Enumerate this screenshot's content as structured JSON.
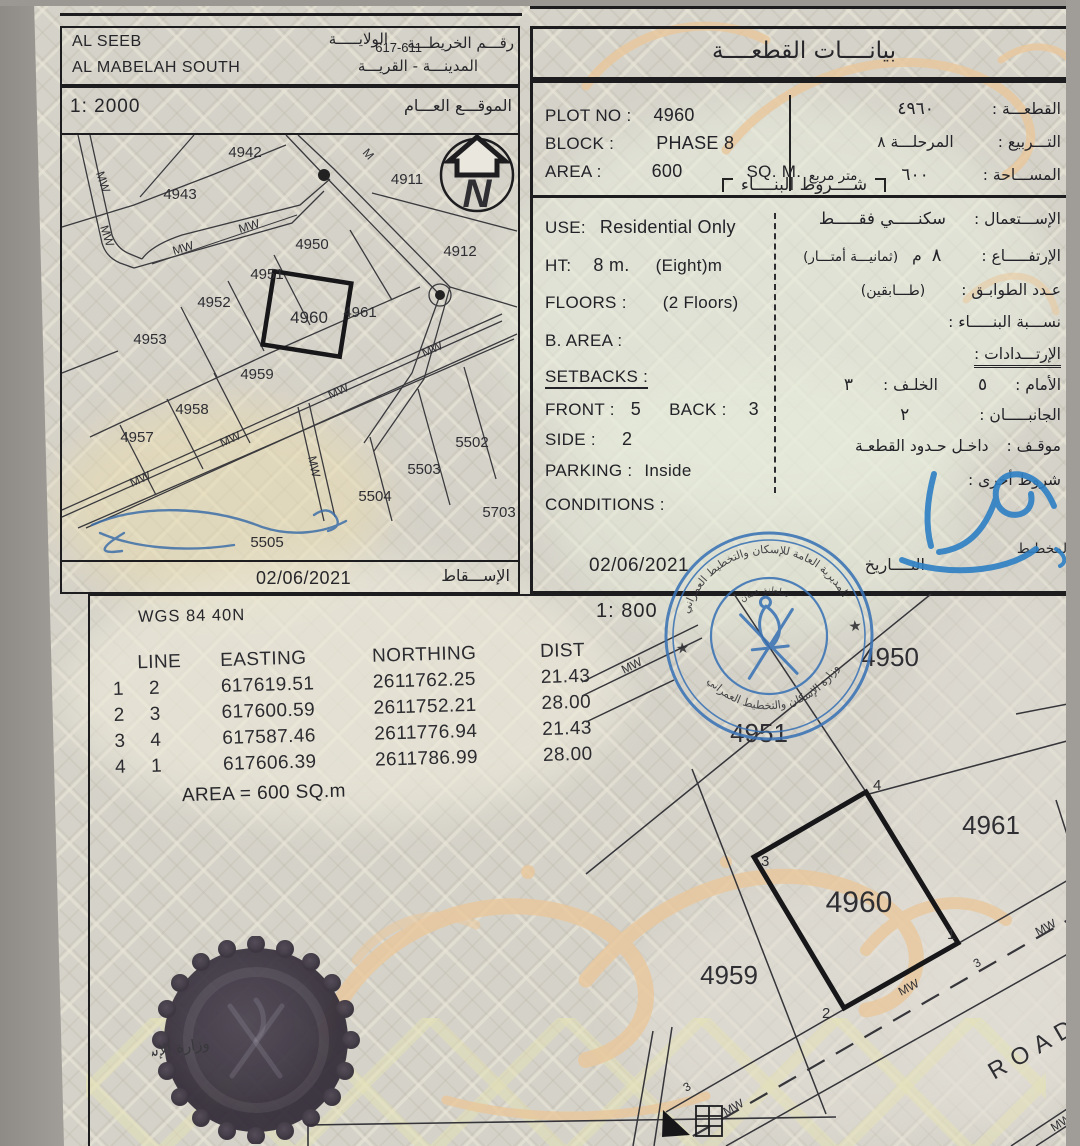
{
  "header_left": {
    "wilaya_en": "AL SEEB",
    "wilaya_label_ar": "الولايـــــة",
    "map_no": "617-611",
    "map_no_label_ar": "رقـــم الخريطـــة",
    "city_en": "AL MABELAH SOUTH",
    "city_label_ar": "المدينـــة - القريـــة"
  },
  "sitemap": {
    "scale": "1: 2000",
    "title_ar": "الموقـــع العـــام",
    "footer_date": "02/06/2021",
    "footer_label_ar": "الإســـقاط",
    "north_letter": "N",
    "road_label": "MW",
    "plots": [
      "4942",
      "4943",
      "4911",
      "4950",
      "4951",
      "4912",
      "4952",
      "4961",
      "4960",
      "4953",
      "4959",
      "4958",
      "4957",
      "5502",
      "5503",
      "5504",
      "5703",
      "5505"
    ]
  },
  "plot_data": {
    "title_ar": "بيانــــات القطعــــة",
    "plot_no_label": "PLOT NO :",
    "plot_no": "4960",
    "plot_no_label_ar": "القطعـــة :",
    "plot_no_ar": "٤٩٦٠",
    "block_label": "BLOCK :",
    "block": "PHASE 8",
    "block_label_ar": "التـــربيع :",
    "block_ar": "المرحلـــة ٨",
    "area_label": "AREA :",
    "area": "600",
    "area_unit": "SQ. M.",
    "area_label_ar": "المســـاحة :",
    "area_ar": "٦٠٠",
    "area_unit_ar": "متر مربع",
    "conditions_title_ar": "شــــروط البنــــاء",
    "use_label": "USE:",
    "use": "Residential Only",
    "use_label_ar": "الإســـتعمال :",
    "use_ar": "سكنـــــي فقـــــط",
    "ht_label": "HT:",
    "ht": "8 m.",
    "ht_extra": "(Eight)m",
    "ht_label_ar": "الإرتفـــــاع :",
    "ht_ar": "٨",
    "ht_unit_ar": "م",
    "ht_extra_ar": "(ثمانيـــة أمتـــار)",
    "floors_label": "FLOORS :",
    "floors": "(2 Floors)",
    "floors_label_ar": "عـدد الطوابـق :",
    "floors_ar": "(طـــابقين)",
    "barea_label": "B. AREA :",
    "barea_label_ar": "نســـبة البنـــــاء :",
    "setbacks_label": "SETBACKS :",
    "setbacks_label_ar": "الإرتـــدادات :",
    "front_label": "FRONT :",
    "front": "5",
    "back_label": "BACK :",
    "back": "3",
    "front_label_ar": "الأمام :",
    "front_ar": "٥",
    "back_label_ar": "الخلـف :",
    "back_ar": "٣",
    "side_label": "SIDE :",
    "side": "2",
    "side_label_ar": "الجانبـــــان :",
    "side_ar": "٢",
    "parking_label": "PARKING :",
    "parking": "Inside",
    "parking_label_ar": "موقـف :",
    "parking_ar": "داخـل حـدود القطعـة",
    "conditions_label": "CONDITIONS :",
    "conditions_label_ar": "شروط أخرى :",
    "date": "02/06/2021",
    "date_label_ar": "التــــاريخ",
    "planner_label_ar": "المخطـط"
  },
  "survey": {
    "scale": "1: 800",
    "datum": "WGS 84  40N",
    "table": {
      "col_line": "LINE",
      "col_easting": "EASTING",
      "col_northing": "NORTHING",
      "col_dist": "DIST",
      "rows": [
        {
          "from": "1",
          "to": "2",
          "easting": "617619.51",
          "northing": "2611762.25",
          "dist": "21.43"
        },
        {
          "from": "2",
          "to": "3",
          "easting": "617600.59",
          "northing": "2611752.21",
          "dist": "28.00"
        },
        {
          "from": "3",
          "to": "4",
          "easting": "617587.46",
          "northing": "2611776.94",
          "dist": "21.43"
        },
        {
          "from": "4",
          "to": "1",
          "easting": "617606.39",
          "northing": "2611786.99",
          "dist": "28.00"
        }
      ],
      "area_note": "AREA = 600  SQ.m"
    },
    "plan": {
      "plots": [
        "4950",
        "4951",
        "4961",
        "4960",
        "4959"
      ],
      "corners": [
        "1",
        "2",
        "3",
        "4"
      ],
      "road": "ROAD",
      "road_label": "MW",
      "width_mark": "3"
    }
  },
  "stamp": {
    "arc_top_ar": "المديرية العامة للإسكان والتخطيط العمراني",
    "arc_bottom_ar": "وزارة الإسكان والتخطيط العمراني",
    "inner_ar": "سلطنة عمان",
    "star": "★"
  },
  "seal": {
    "text_ar": "وزارة الإسكان"
  },
  "colors": {
    "stamp_blue": "#3a72b4",
    "signature_blue": "#2f80c4",
    "watermark_tan": "#e9c79b",
    "paper": "#d5d2c9",
    "ink": "#26262a"
  }
}
